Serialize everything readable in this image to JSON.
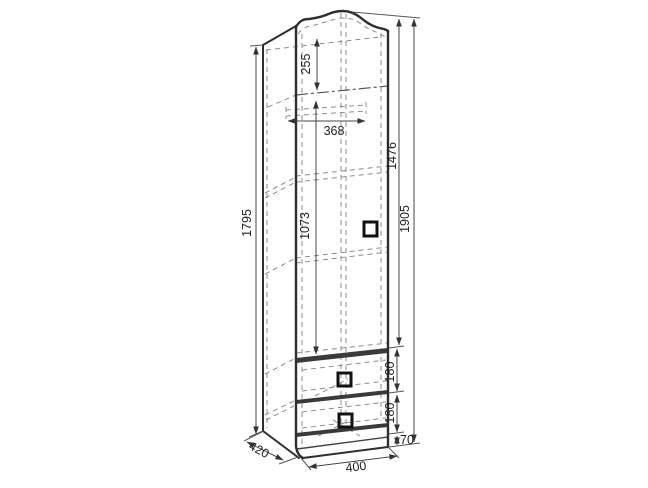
{
  "diagram": {
    "type": "furniture-dimension-drawing",
    "subject": "wardrobe",
    "dimensions": {
      "side_height": "1795",
      "top_section": "255",
      "rod_width": "368",
      "hanging_section": "1073",
      "door_height": "1476",
      "total_height": "1905",
      "drawer_top": "180",
      "drawer_bottom": "180",
      "plinth": "70",
      "width": "400",
      "depth": "420"
    },
    "colors": {
      "background": "#ffffff",
      "outline": "#2e2e2e",
      "dashed": "#8c8c8c",
      "dimension_line": "#444444",
      "text": "#1f1f1f"
    }
  }
}
